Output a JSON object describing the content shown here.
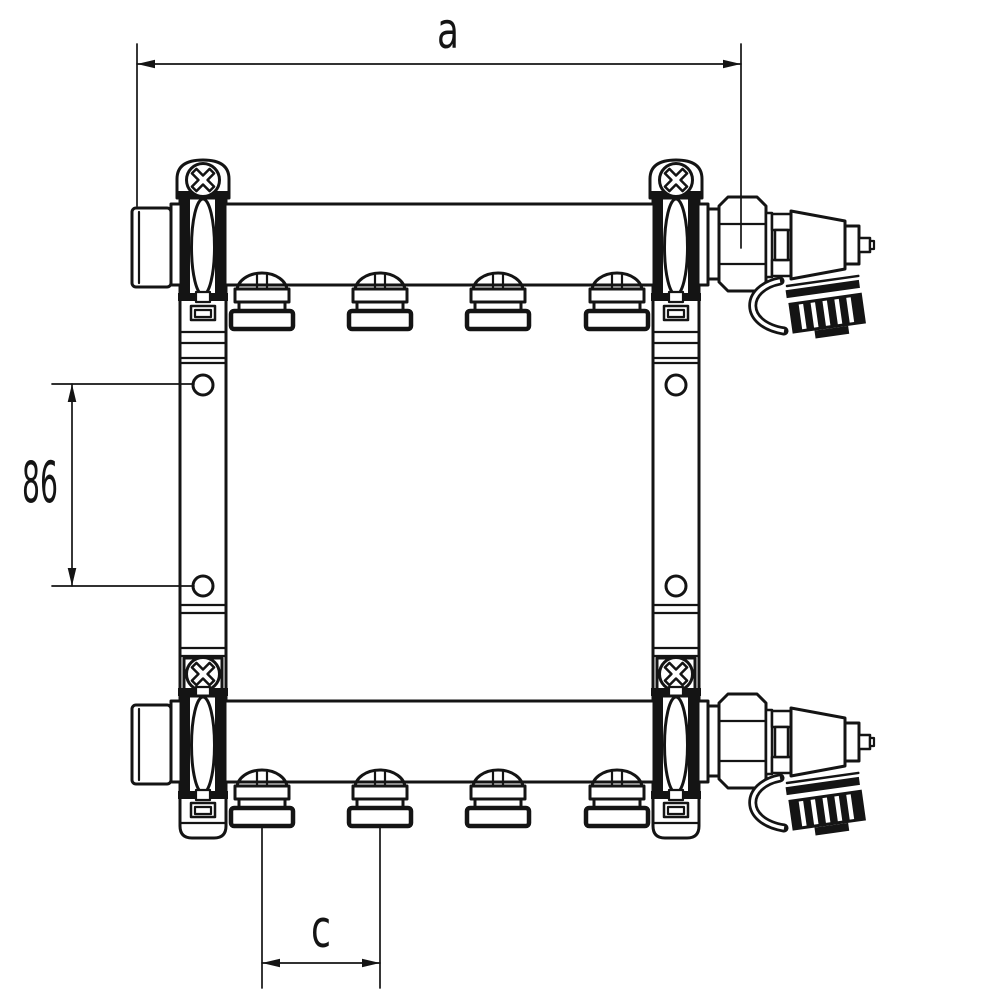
{
  "page": {
    "background": "#ffffff",
    "line_color": "#141414"
  },
  "drawing": {
    "kind": "technical line drawing",
    "subject": "heating manifold set, front view, two manifold bars with four outlets each, wall brackets and fill/drain valves",
    "labels": {
      "dim_a": "a",
      "dim_86": "86",
      "dim_c": "c"
    },
    "dimensions": {
      "a": {
        "label": "a",
        "orientation": "horizontal",
        "position": "top",
        "measures": "end cap to union nut centre"
      },
      "v86": {
        "label": "86",
        "orientation": "vertical",
        "position": "left",
        "measures": "bracket mounting hole spacing"
      },
      "c": {
        "label": "c",
        "orientation": "horizontal",
        "position": "bottom",
        "measures": "outlet centre spacing"
      }
    },
    "structure": {
      "manifold_bars": 2,
      "outlets_per_bar": 4,
      "brackets": 2,
      "mounting_holes_per_bracket": 2,
      "screws_per_bracket": 2,
      "valves": 2
    }
  }
}
